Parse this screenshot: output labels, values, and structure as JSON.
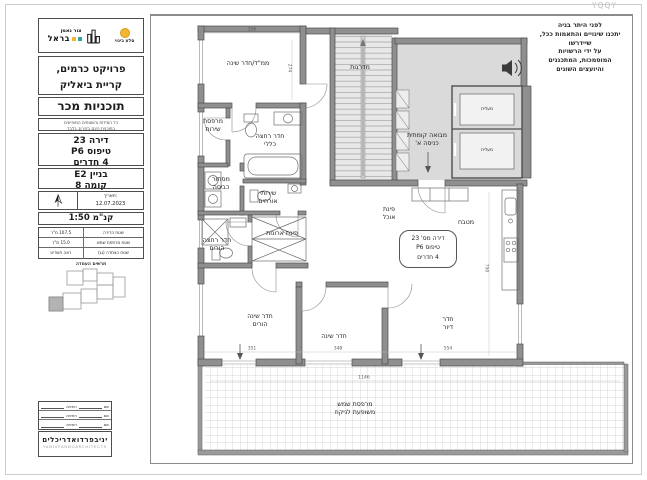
{
  "stamp": "YQQY",
  "disclaimer": "לפני היתר בניה\nיתכנו שינויים והתאמות ככל,\nשיידרשו\nעל ידי הרשויות\nהמוסמכות, המתכננים\nוהיועצים השונים",
  "sidebar": {
    "logo": {
      "left_top": "סלע בינוי",
      "right_main": "צור נאמן",
      "right_bold": "בראל"
    },
    "project": "פרויקט כרמים,\nקריית ביאליק",
    "doc_title": "תוכניות מכר",
    "note": "כל המידות והשטחים המופיעים\nבתוכנית הינם בקירוב בלבד",
    "apartment": {
      "l1": "דירה 23",
      "l2": "טיפוס P6",
      "l3": "4 חדרים"
    },
    "building": {
      "l1": "בניין E2",
      "l2": "קומה 8"
    },
    "date": {
      "label": "תאריך:",
      "value": "12.07.2023"
    },
    "scale": "קנ\"מ  1:50",
    "areas": {
      "rows": [
        {
          "label": "שטח הדירה",
          "value": "107.5 מ\"ר"
        },
        {
          "label": "שטח מרפסת שמש",
          "value": "15.0 מ\"ר"
        },
        {
          "label": "שטח הצמדה (גג)",
          "value": "ראה תשריט"
        }
      ]
    },
    "keyplan_caption": "תרשים העמדה",
    "signatures": {
      "name_label": "שם",
      "sign_label": "חתימה"
    },
    "architect": {
      "he": "יניבפרדואדריכלים",
      "en": "YANIVPARDOARCHITECTS"
    }
  },
  "plan": {
    "rooms": {
      "mamad": "ממ\"ד/חדר שינה",
      "stairs": "מדרגות",
      "lobby": "מבואה קומתית\nכניסה א'",
      "elevator1": "מעלית",
      "elevator2": "מעלית",
      "service_balcony": "מרפסת\nשירות",
      "bath_general": "חדר רחצה\nכללי",
      "laundry": "מסתור\nכביסה",
      "guest_wc": "שירותי\nאורחים",
      "bath_parents": "חדר רחצה\nהורים",
      "closets": "פינת ארונות",
      "dining": "פינת\nאוכל",
      "kitchen": "מטבח",
      "bed_parents": "חדר שינה\nהורים",
      "bedroom": "חדר שינה",
      "living": "חדר\nדיור",
      "balcony": "מרפסת שמש\nמשופעת לניקוז"
    },
    "unit_tag": {
      "l1": "דירה מס' 23",
      "l2": "טיפוס P6",
      "l3": "4 חדרים"
    },
    "dims": {
      "d336": "336",
      "d274": "274",
      "d351": "351",
      "d348": "348",
      "d554": "554",
      "d750": "750",
      "d1146": "1146"
    }
  }
}
